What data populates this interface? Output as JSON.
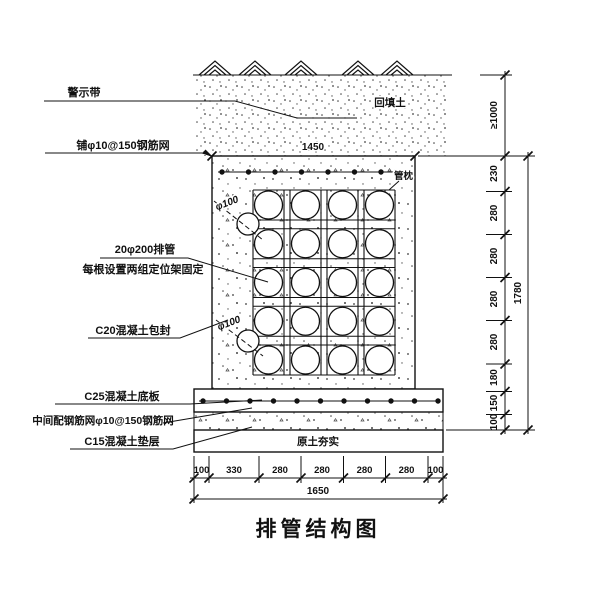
{
  "title": "排管结构图",
  "labels_left": [
    {
      "text": "警示带"
    },
    {
      "text": "铺φ10@150钢筋网"
    },
    {
      "text": "20φ200排管"
    },
    {
      "text": "每根设置两组定位架固定"
    },
    {
      "text": "C20混凝土包封"
    },
    {
      "text": "C25混凝土底板"
    },
    {
      "text": "中间配钢筋网φ10@150钢筋网"
    },
    {
      "text": "C15混凝土垫层"
    }
  ],
  "annotations": {
    "backfill": "回填土",
    "pipe_cradle": "管枕",
    "subgrade": "原土夯实",
    "duct_dia_upper": "φ100",
    "duct_dia_lower": "φ100"
  },
  "dimensions": {
    "top_width": "1450",
    "bottom_overall": "1650",
    "bottom_segments": [
      "100",
      "330",
      "280",
      "280",
      "280",
      "280",
      "100"
    ],
    "right_cover": "≥1000",
    "right_overall": "1780",
    "right_segments": [
      "230",
      "280",
      "280",
      "280",
      "280",
      "180",
      "150",
      "100"
    ]
  },
  "structure": {
    "pipe_rows": 5,
    "pipe_cols": 4,
    "pipe_total": 20
  },
  "colors": {
    "ink": "#111111",
    "paper": "#ffffff"
  }
}
